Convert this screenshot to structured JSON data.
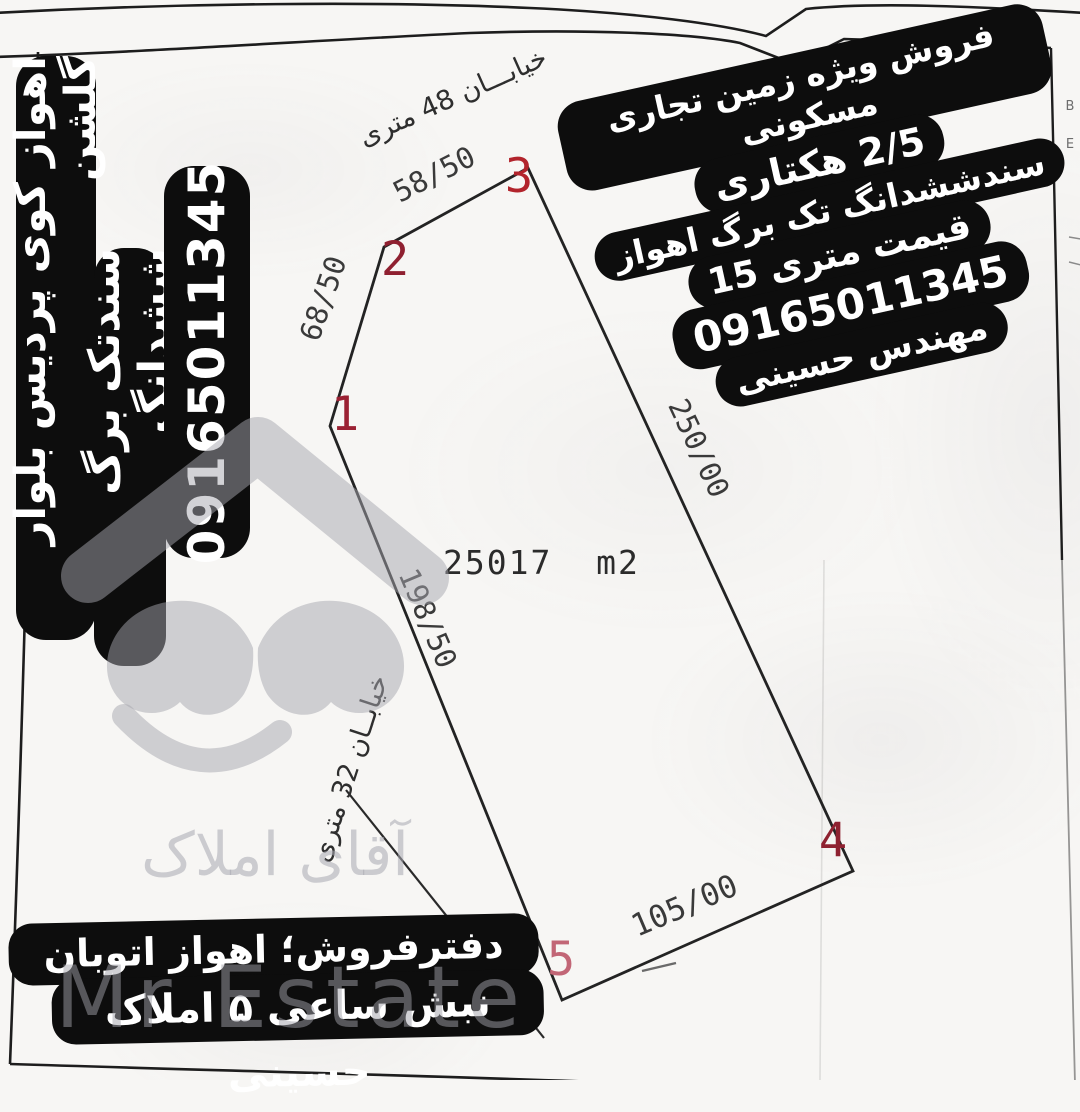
{
  "watermark": {
    "brand_fa": "آقای املاک",
    "brand_en": "Mr Estate",
    "logo": "house-mustache-logo",
    "color": "#a8a8b0"
  },
  "left_banner": {
    "lines": [
      "اهواز کوی پردیس بلوار گلشن",
      "سندتک برگ ششدانگ",
      "09165011345"
    ]
  },
  "top_right_banner": {
    "lines": [
      "فروش ویژه زمین تجاری مسکونی",
      "2/5 هکتاری",
      "سندششدانگ تک برگ اهواز",
      "قیمت متری 15",
      "09165011345",
      "مهندس حسینی"
    ]
  },
  "bottom_banner": {
    "lines": [
      "دفترفروش؛ اهواز اتوبان گلستان",
      "نبش ساعی ۵ املاک حسینی"
    ]
  },
  "plan": {
    "area_label": "25017  m2",
    "street_top": "خیابـــان 48 متری",
    "street_left": "خیابــان 32 متری",
    "vertices": [
      {
        "id": "1"
      },
      {
        "id": "2"
      },
      {
        "id": "3"
      },
      {
        "id": "4"
      },
      {
        "id": "5"
      }
    ],
    "edges": [
      {
        "from": "1",
        "to": "2",
        "length": "68/50"
      },
      {
        "from": "2",
        "to": "3",
        "length": "58/50"
      },
      {
        "from": "3",
        "to": "4",
        "length": "250/00"
      },
      {
        "from": "4",
        "to": "5",
        "length": "105/00"
      },
      {
        "from": "5",
        "to": "1",
        "length": "198/50"
      }
    ],
    "line_color": "#232323",
    "vertex_color": "#a12433"
  },
  "margin_marks": {
    "letters": [
      "B",
      "E"
    ]
  }
}
